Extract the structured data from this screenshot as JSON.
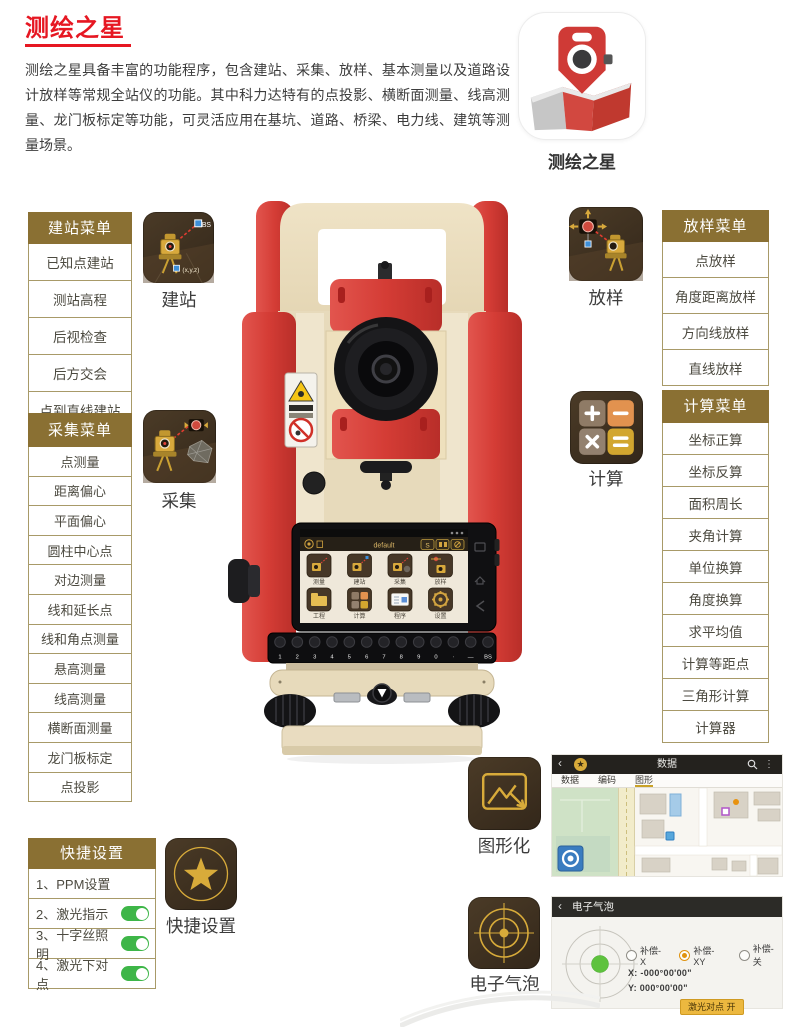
{
  "page": {
    "title": "测绘之星",
    "description": "测绘之星具备丰富的功能程序，包含建站、采集、放样、基本测量以及道路设计放样等常规全站仪的功能。其中科力达特有的点投影、横断面测量、线高测量、龙门板标定等功能，可灵活应用在基坑、道路、桥梁、电力线、建筑等测量场景。"
  },
  "app_icon": {
    "label": "测绘之星"
  },
  "colors": {
    "accent_red": "#e61722",
    "menu_header_bg": "#8a7033",
    "gold": "#d8ab3a",
    "toggle_green": "#3eb648",
    "product_red": "#d9453f"
  },
  "menus": {
    "station": {
      "title": "建站菜单",
      "items": [
        "已知点建站",
        "测站高程",
        "后视检查",
        "后方交会",
        "点到直线建站"
      ]
    },
    "collect": {
      "title": "采集菜单",
      "items": [
        "点测量",
        "距离偏心",
        "平面偏心",
        "圆柱中心点",
        "对边测量",
        "线和延长点",
        "线和角点测量",
        "悬高测量",
        "线高测量",
        "横断面测量",
        "龙门板标定",
        "点投影"
      ]
    },
    "stakeout": {
      "title": "放样菜单",
      "items": [
        "点放样",
        "角度距离放样",
        "方向线放样",
        "直线放样"
      ]
    },
    "calc": {
      "title": "计算菜单",
      "items": [
        "坐标正算",
        "坐标反算",
        "面积周长",
        "夹角计算",
        "单位换算",
        "角度换算",
        "求平均值",
        "计算等距点",
        "三角形计算",
        "计算器"
      ]
    },
    "quick": {
      "title": "快捷设置",
      "items": [
        {
          "label": "1、PPM设置",
          "toggle": false
        },
        {
          "label": "2、激光指示",
          "toggle": true
        },
        {
          "label": "3、十字丝照明",
          "toggle": true
        },
        {
          "label": "4、激光下对点",
          "toggle": true
        }
      ]
    }
  },
  "features": {
    "station": "建站",
    "stakeout": "放样",
    "collect": "采集",
    "calc": "计算",
    "quick": "快捷设置",
    "graphic": "图形化",
    "bubble": "电子气泡"
  },
  "station_icon_labels": {
    "bs": "BS",
    "xyz": "(x,y,z)"
  },
  "device": {
    "screen_title": "default",
    "s_button": "S",
    "apps": [
      "测量",
      "建站",
      "采集",
      "放样",
      "工程",
      "计算",
      "程序",
      "设置"
    ],
    "keys": [
      "1",
      "2",
      "3",
      "4",
      "5",
      "6",
      "7",
      "8",
      "9",
      "0",
      "·",
      "—",
      "BS"
    ]
  },
  "map_screen": {
    "title": "数据",
    "tabs": [
      "数据",
      "编码",
      "图形"
    ],
    "active_tab": "图形"
  },
  "bubble_screen": {
    "title": "电子气泡",
    "radios": [
      {
        "label": "补偿-X",
        "checked": false
      },
      {
        "label": "补偿-XY",
        "checked": true
      },
      {
        "label": "补偿-关",
        "checked": false
      }
    ],
    "x_label": "X:",
    "x_value": "-000°00'00\"",
    "y_label": "Y:",
    "y_value": "000°00'00\"",
    "button_label": "激光对点 开"
  }
}
